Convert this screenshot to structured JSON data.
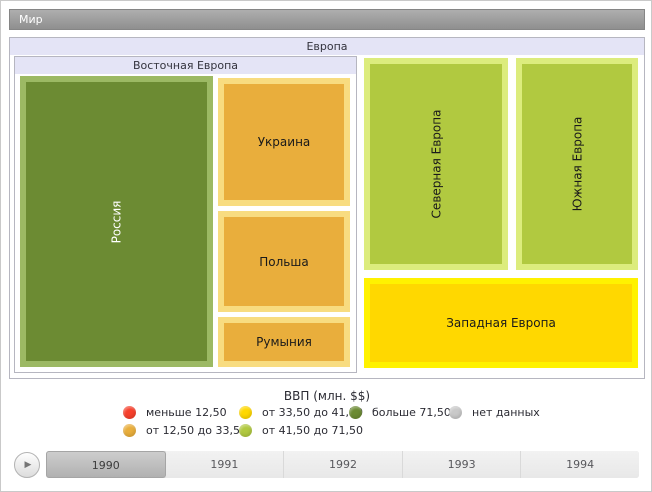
{
  "root": {
    "label": "Мир"
  },
  "treemap": {
    "group_label": "Европа",
    "subgroup_label": "Восточная Европа",
    "tiles": {
      "russia": {
        "label": "Россия",
        "fill": "#6c8b33",
        "border": "#9cb964",
        "text": "#ffffff"
      },
      "ukraine": {
        "label": "Украина",
        "fill": "#e9ae3c",
        "border": "#f8dc80",
        "text": "#1a1a1a"
      },
      "poland": {
        "label": "Польша",
        "fill": "#e9ae3c",
        "border": "#f8dc80",
        "text": "#1a1a1a"
      },
      "romania": {
        "label": "Румыния",
        "fill": "#e9ae3c",
        "border": "#f8dc80",
        "text": "#1a1a1a"
      },
      "northern": {
        "label": "Северная Европа",
        "fill": "#b1c940",
        "border": "#dcec7d",
        "text": "#1a1a1a"
      },
      "southern": {
        "label": "Южная Европа",
        "fill": "#b1c940",
        "border": "#dcec7d",
        "text": "#1a1a1a"
      },
      "western": {
        "label": "Западная Европа",
        "fill": "#ffd800",
        "border": "#fff200",
        "text": "#1a1a1a"
      }
    }
  },
  "legend": {
    "title": "ВВП (млн. $$)",
    "items": [
      {
        "label": "меньше 12,50",
        "color": "#f6402c"
      },
      {
        "label": "от 12,50 до 33,50",
        "color": "#e9ae3c"
      },
      {
        "label": "от 33,50 до 41,50",
        "color": "#ffd800"
      },
      {
        "label": "от 41,50 до 71,50",
        "color": "#b1c940"
      },
      {
        "label": "больше 71,50",
        "color": "#6c8b33"
      },
      {
        "label": "нет данных",
        "color": "#c9c9c9"
      }
    ]
  },
  "timeline": {
    "play_icon": "▶",
    "years": [
      {
        "label": "1990",
        "selected": true
      },
      {
        "label": "1991",
        "selected": false
      },
      {
        "label": "1992",
        "selected": false
      },
      {
        "label": "1993",
        "selected": false
      },
      {
        "label": "1994",
        "selected": false
      }
    ]
  },
  "chart_data": {
    "type": "treemap",
    "title": "Мир",
    "legend_title": "ВВП (млн. $$)",
    "legend_position": "bottom",
    "bins": [
      {
        "label": "меньше 12,50",
        "color": "#f6402c"
      },
      {
        "label": "от 12,50 до 33,50",
        "color": "#e9ae3c"
      },
      {
        "label": "от 33,50 до 41,50",
        "color": "#ffd800"
      },
      {
        "label": "от 41,50 до 71,50",
        "color": "#b1c940"
      },
      {
        "label": "больше 71,50",
        "color": "#6c8b33"
      },
      {
        "label": "нет данных",
        "color": "#c9c9c9"
      }
    ],
    "hierarchy": {
      "name": "Мир",
      "children": [
        {
          "name": "Европа",
          "children": [
            {
              "name": "Восточная Европа",
              "children": [
                {
                  "name": "Россия",
                  "bin": "больше 71,50"
                },
                {
                  "name": "Украина",
                  "bin": "от 12,50 до 33,50"
                },
                {
                  "name": "Польша",
                  "bin": "от 12,50 до 33,50"
                },
                {
                  "name": "Румыния",
                  "bin": "от 12,50 до 33,50"
                }
              ]
            },
            {
              "name": "Северная Европа",
              "bin": "от 41,50 до 71,50"
            },
            {
              "name": "Южная Европа",
              "bin": "от 41,50 до 71,50"
            },
            {
              "name": "Западная Европа",
              "bin": "от 33,50 до 41,50"
            }
          ]
        }
      ]
    },
    "time_axis": [
      "1990",
      "1991",
      "1992",
      "1993",
      "1994"
    ],
    "selected_time": "1990"
  }
}
